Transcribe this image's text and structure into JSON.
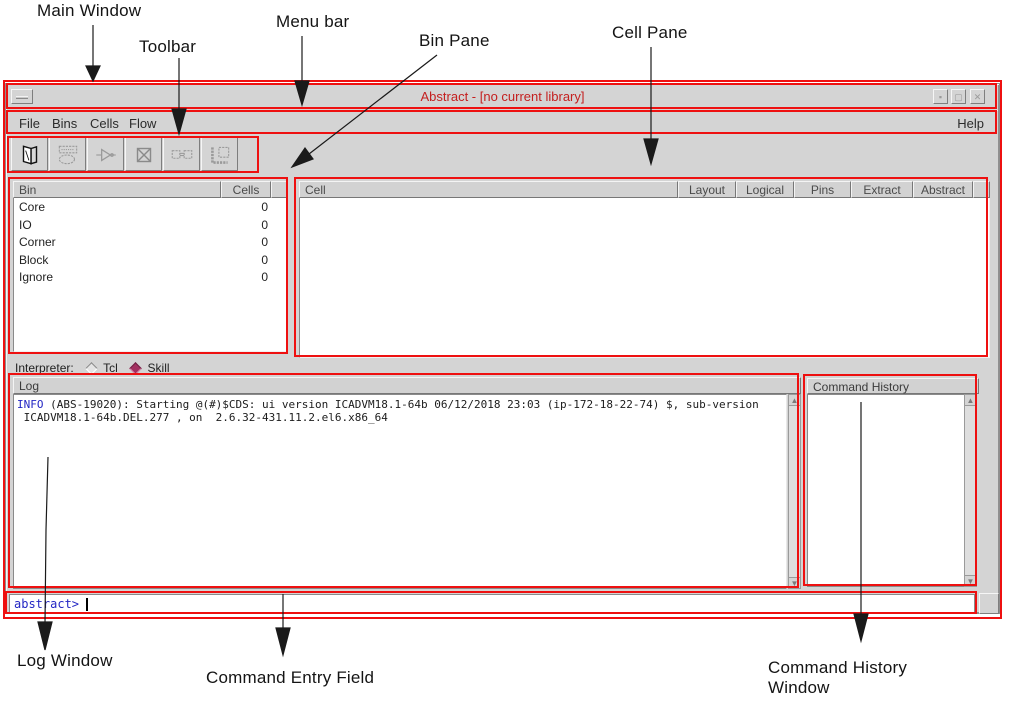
{
  "annotations": {
    "main_window": "Main Window",
    "toolbar": "Toolbar",
    "menu_bar": "Menu bar",
    "bin_pane": "Bin Pane",
    "cell_pane": "Cell Pane",
    "log_window": "Log Window",
    "command_entry_field": "Command Entry Field",
    "command_history_line1": "Command History",
    "command_history_line2": "Window"
  },
  "window": {
    "title": "Abstract - [no current library]",
    "menu_items": [
      "File",
      "Bins",
      "Cells",
      "Flow"
    ],
    "help_label": "Help",
    "toolbar_icons": [
      "library-icon",
      "layout-icon",
      "logical-icon",
      "pins-icon",
      "extract-icon",
      "abstract-icon"
    ]
  },
  "bin_pane": {
    "columns": [
      "Bin",
      "Cells"
    ],
    "rows": [
      {
        "bin": "Core",
        "cells": "0"
      },
      {
        "bin": "IO",
        "cells": "0"
      },
      {
        "bin": "Corner",
        "cells": "0"
      },
      {
        "bin": "Block",
        "cells": "0"
      },
      {
        "bin": "Ignore",
        "cells": "0"
      }
    ]
  },
  "cell_pane": {
    "columns": [
      "Cell",
      "Layout",
      "Logical",
      "Pins",
      "Extract",
      "Abstract"
    ]
  },
  "interpreter": {
    "label": "Interpreter:",
    "options": [
      {
        "label": "Tcl",
        "selected": false
      },
      {
        "label": "Skill",
        "selected": true
      }
    ]
  },
  "log": {
    "header": "Log",
    "info_label": "INFO",
    "line1_rest": " (ABS-19020): Starting @(#)$CDS: ui version ICADVM18.1-64b 06/12/2018 23:03 (ip-172-18-22-74) $, sub-version",
    "line2": " ICADVM18.1-64b.DEL.277 , on  2.6.32-431.11.2.el6.x86_64"
  },
  "command_history": {
    "header": "Command History"
  },
  "command_entry": {
    "prompt": "abstract>"
  },
  "colors": {
    "annotation_red": "#ee1010",
    "title_red": "#c42020",
    "info_blue": "#2326c4",
    "prompt_blue": "#2326c4",
    "skill_diamond": "#a23060",
    "window_gray": "#d4d4d4"
  }
}
